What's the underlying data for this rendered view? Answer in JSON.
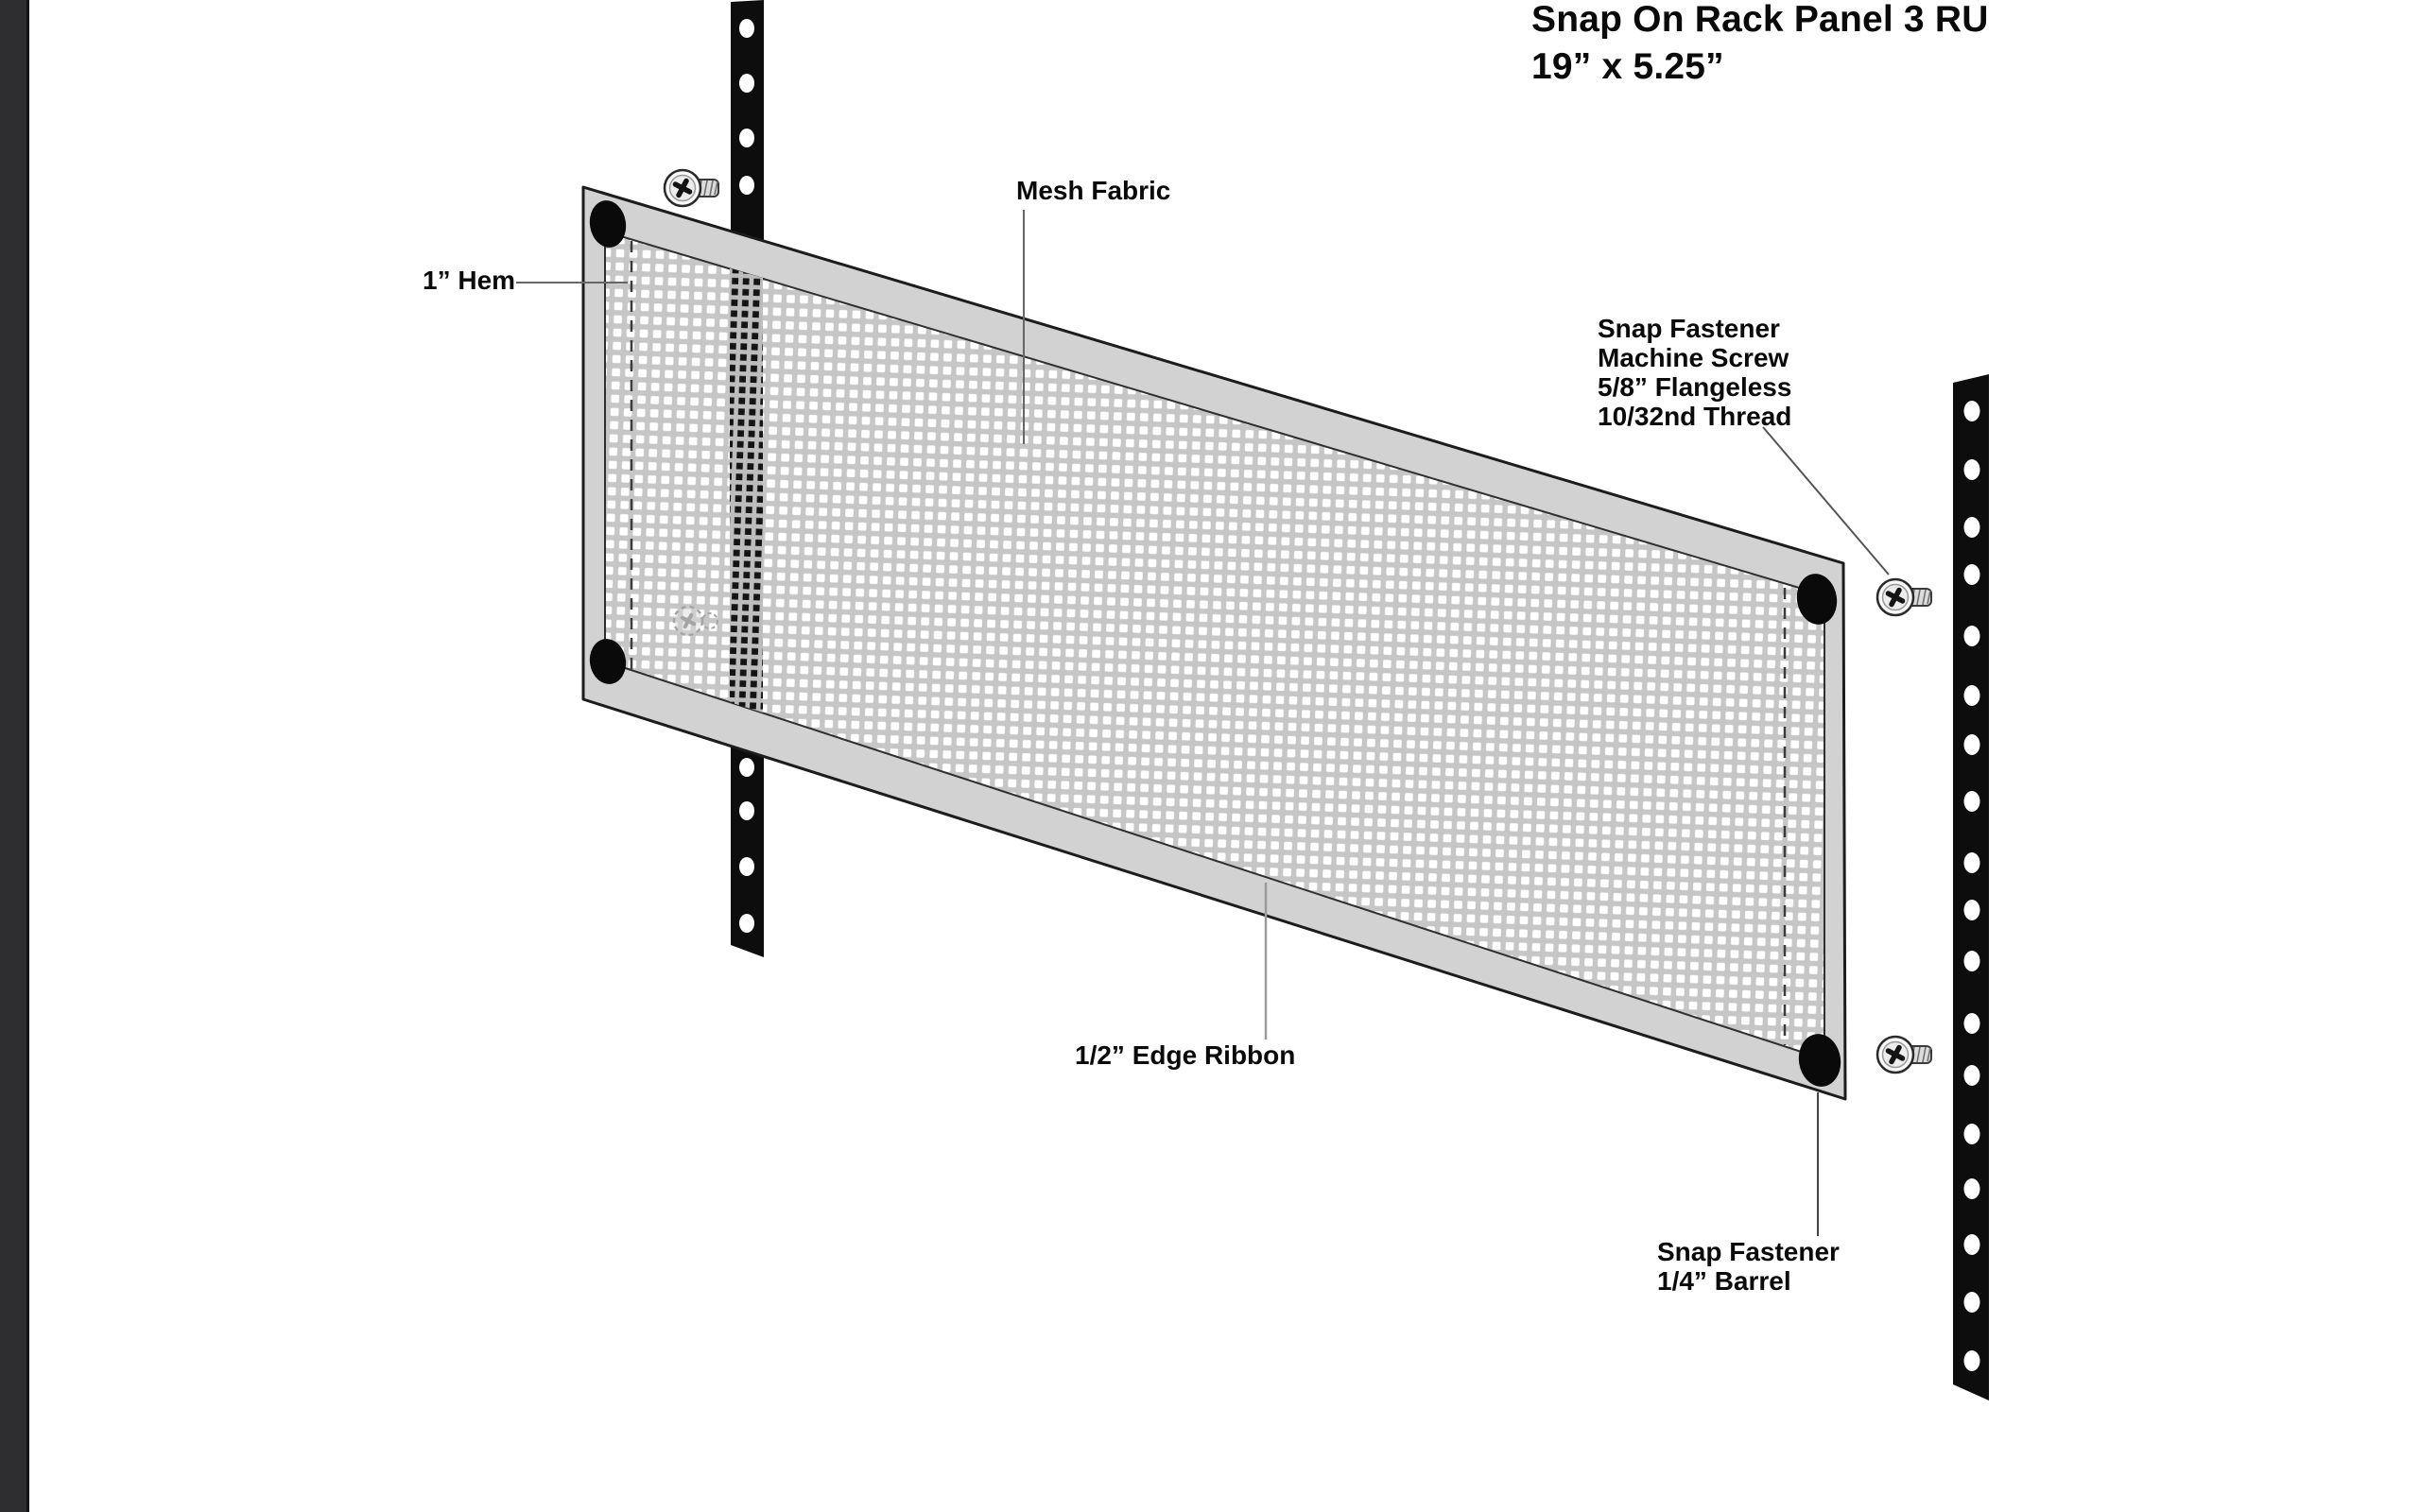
{
  "title": {
    "text": "Snap On Rack Panel 3 RU\n19” x 5.25”"
  },
  "labels": {
    "hem": "1” Hem",
    "mesh_fabric": "Mesh Fabric",
    "snap_fastener_machine_screw": "Snap Fastener\nMachine Screw\n5/8” Flangeless\n10/32nd Thread",
    "edge_ribbon": "1/2” Edge Ribbon",
    "snap_fastener_barrel": "Snap Fastener\n1/4” Barrel"
  },
  "diagram": {
    "colors": {
      "rail": "#0d0d0d",
      "rail_hole": "#ffffff",
      "ribbon": "#d2d2d2",
      "mesh_base": "#c6c6c6",
      "mesh_dot": "#ffffff",
      "snap_barrel": "#0a0a0a",
      "outline": "#1c1c1c",
      "edge_strip": "#2e2e30",
      "background": "#ffffff"
    }
  }
}
